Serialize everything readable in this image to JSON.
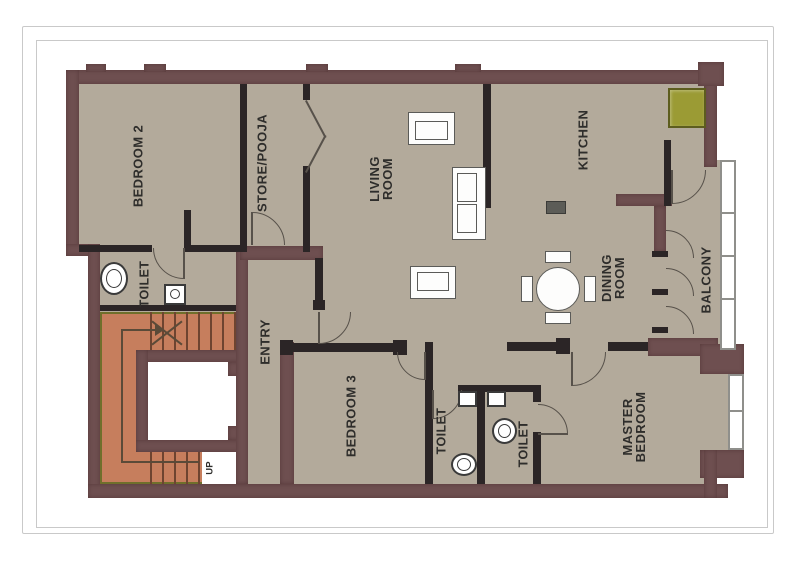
{
  "plan": {
    "rooms": {
      "bedroom2": "BEDROOM 2",
      "bedroom2_toilet": "TOILET",
      "store_pooja": "STORE/POOJA",
      "entry": "ENTRY",
      "living_room": "LIVING ROOM",
      "kitchen": "KITCHEN",
      "dining_room": "DINING ROOM",
      "balcony": "BALCONY",
      "bedroom3": "BEDROOM 3",
      "toilet_common": "TOILET",
      "toilet_master": "TOILET",
      "master_bedroom": "MASTER BEDROOM",
      "stairs_direction": "UP"
    },
    "colors": {
      "wall": "#6E4F50",
      "iwall": "#2B2526",
      "floor": "#B3AA9B",
      "stairs": "#C67E5D",
      "tread": "#6E4430",
      "stairs-outline": "#6F6F2B",
      "counter": "#9B9B34",
      "counter-border": "#5D5D1E",
      "winframe": "#8F8F8B",
      "fixture": "#3A3A3A",
      "furniture": "#5B5B58",
      "arc": "#57514A",
      "label": "#2E2D2B",
      "page-border": "#C9C9C9",
      "stove": "#5C5C57",
      "arrow": "#5A4A38"
    }
  }
}
